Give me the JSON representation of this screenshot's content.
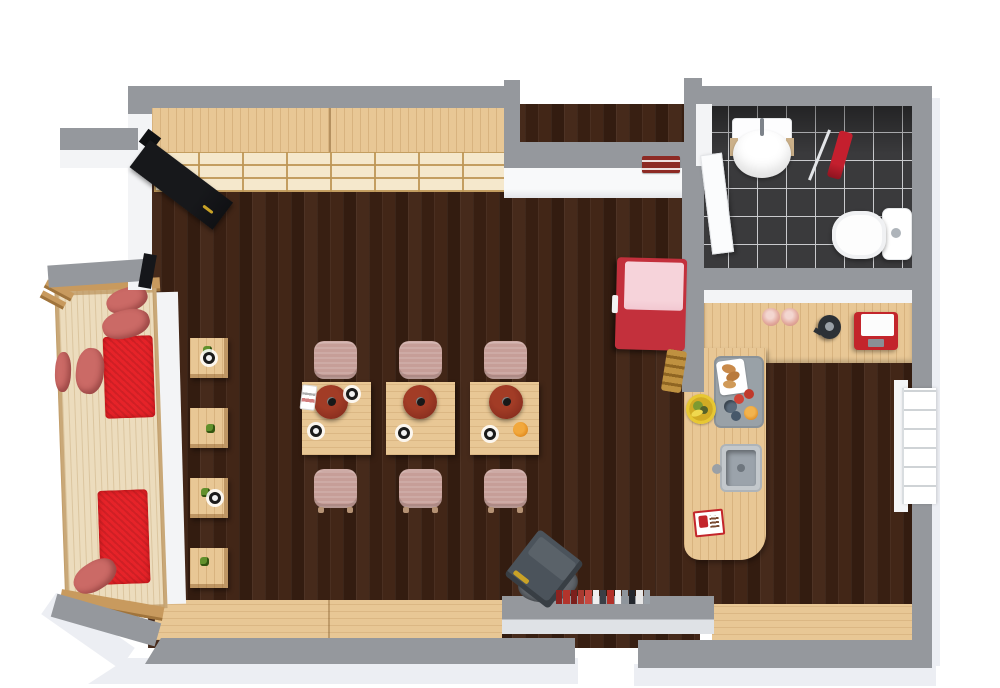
{
  "view": {
    "type": "3d-floor-plan-top-view",
    "scene": "cafe-with-bathroom-and-kitchen",
    "rendered_text": []
  },
  "palette": {
    "wall": "#95989d",
    "wall-face": "#f3f4f6",
    "base-shadow": "#eceef3",
    "floor-dark": "#3f2518",
    "tile": "#3a3a3c",
    "grout": "#c9cacd",
    "wood": "#e8c795",
    "wood-cream": "#f5e8cc",
    "bench-cream": "#ecdcbd",
    "frame-tan": "#c89a5e",
    "cushion-red": "#e62329",
    "pillow": "#cb6a66",
    "chair": "#c69e98",
    "lamp": "#8e3120",
    "plant-green": "#61902c",
    "fridge-red": "#c3303c",
    "fridge-pink": "#f2c8d1",
    "towel-red": "#c41f2e",
    "stove-gray": "#4b535b",
    "sign-red": "#8d2a24",
    "tray-gray": "#99a1a7",
    "orange": "#e08a1e",
    "plate-yellow": "#e7c733",
    "machine-red": "#c3252b",
    "canister-pink": "#e2a89c",
    "gold": "#c9a227"
  },
  "books": [
    "#8d2320",
    "#b3342c",
    "#7c1f1c",
    "#a93a30",
    "#c74840",
    "#efefef",
    "#3a3f46",
    "#b23028",
    "#f2f2f2",
    "#8e959c",
    "#23272e",
    "#e8e8e8",
    "#9aa1a8"
  ],
  "inventory": {
    "rooms": [
      {
        "name": "dining-room",
        "floor": "dark-wood-planks"
      },
      {
        "name": "bathroom",
        "floor": "black-tile"
      },
      {
        "name": "kitchen",
        "floor": "dark-wood-planks"
      }
    ],
    "furniture": [
      {
        "name": "wall-shelf-unit",
        "count": 1
      },
      {
        "name": "entry-door-black",
        "count": 1
      },
      {
        "name": "daybed-bench-with-red-cushions",
        "count": 1
      },
      {
        "name": "side-stool-with-plant",
        "count": 4
      },
      {
        "name": "dining-table",
        "count": 3
      },
      {
        "name": "pendant-lamp",
        "count": 3
      },
      {
        "name": "dining-chair",
        "count": 6
      },
      {
        "name": "retro-fridge-red",
        "count": 1
      },
      {
        "name": "wood-stove",
        "count": 1
      },
      {
        "name": "window-bench",
        "count": 2
      },
      {
        "name": "bathroom-sink",
        "count": 1
      },
      {
        "name": "toilet",
        "count": 1
      },
      {
        "name": "red-towel-on-rail",
        "count": 1
      },
      {
        "name": "l-shaped-kitchen-counter",
        "count": 1
      },
      {
        "name": "kitchen-sink",
        "count": 1
      },
      {
        "name": "coffee-machine",
        "count": 1
      },
      {
        "name": "kettle",
        "count": 1
      },
      {
        "name": "breakfast-tray",
        "count": 1
      },
      {
        "name": "fruit-plate",
        "count": 1
      },
      {
        "name": "book-row",
        "count": 1
      },
      {
        "name": "wall-sign-red",
        "count": 2
      }
    ]
  }
}
